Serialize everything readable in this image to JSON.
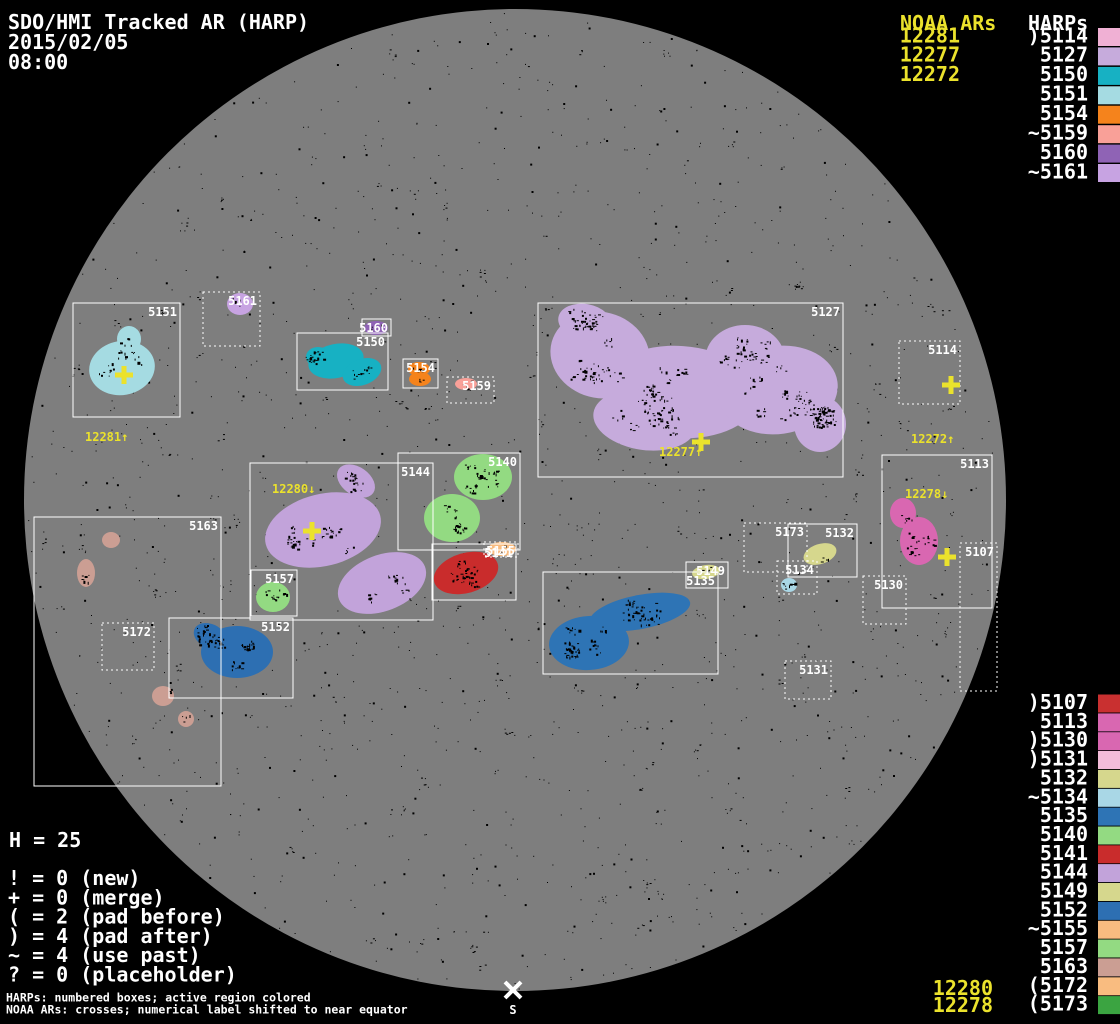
{
  "app": {
    "title": "SDO/HMI Tracked AR (HARP)",
    "date": "2015/02/05",
    "time": "08:00"
  },
  "colors": {
    "background": "#000000",
    "disk_gray": "#7e7e7e",
    "accent_yellow": "#ebe22c",
    "label_white": "#ffffff",
    "box_stroke": "#ffffff",
    "speckle_black": "#000000"
  },
  "columns": {
    "noaa_header": "NOAA ARs",
    "harps_header": "HARPs"
  },
  "noaa_top_list": [
    "12281",
    "12277",
    "12272"
  ],
  "noaa_bottom_list": [
    {
      "text": "12280",
      "baseline": 995
    },
    {
      "text": "12278",
      "baseline": 1012
    }
  ],
  "harps_top_list": [
    {
      "label": ")5114",
      "color": "#f0b0d4"
    },
    {
      "label": "5127",
      "color": "#c6abdc"
    },
    {
      "label": "5150",
      "color": "#17b1c3"
    },
    {
      "label": "5151",
      "color": "#a5dbe2"
    },
    {
      "label": "5154",
      "color": "#f5831c"
    },
    {
      "label": "~5159",
      "color": "#f9a098"
    },
    {
      "label": "5160",
      "color": "#8f63b5"
    },
    {
      "label": "~5161",
      "color": "#c7a3e2"
    }
  ],
  "harps_bottom_list": [
    {
      "label": ")5107",
      "color": "#c93030"
    },
    {
      "label": "5113",
      "color": "#d967b1"
    },
    {
      "label": ")5130",
      "color": "#d967b1"
    },
    {
      "label": ")5131",
      "color": "#f3bcd9"
    },
    {
      "label": "5132",
      "color": "#d6d78d"
    },
    {
      "label": "~5134",
      "color": "#a9d7e6"
    },
    {
      "label": "5135",
      "color": "#2e74b5"
    },
    {
      "label": "5140",
      "color": "#93da82"
    },
    {
      "label": "5141",
      "color": "#c92c2c"
    },
    {
      "label": "5144",
      "color": "#c2a3da"
    },
    {
      "label": "5149",
      "color": "#d6d78d"
    },
    {
      "label": "5152",
      "color": "#2d6fb2"
    },
    {
      "label": "~5155",
      "color": "#f9bc80"
    },
    {
      "label": "5157",
      "color": "#93da82"
    },
    {
      "label": "5163",
      "color": "#cb9e93"
    },
    {
      "label": "(5172",
      "color": "#f9bc80"
    },
    {
      "label": "(5173",
      "color": "#3ba441"
    }
  ],
  "legend": {
    "harp_count": "H = 25",
    "items": [
      "! = 0 (new)",
      "+ = 0 (merge)",
      "( = 2 (pad before)",
      ") = 4 (pad after)",
      "~ = 4 (use past)",
      "? = 0 (placeholder)"
    ]
  },
  "footnotes": [
    "HARPs: numbered boxes; active region colored",
    "NOAA ARs: crosses; numerical label shifted to near equator"
  ],
  "south_marker": {
    "label": "S",
    "x": 513,
    "y": 990
  },
  "chart_data": {
    "type": "scatter",
    "title": "SDO/HMI Tracked AR (HARP)",
    "datetime": "2015/02/05 08:00",
    "sun_disk": {
      "cx": 515,
      "cy": 500,
      "r": 491
    },
    "harp_regions": [
      {
        "harp": "5151",
        "box": [
          73,
          303,
          107,
          114
        ],
        "dashed": false,
        "color": "#a5dbe2",
        "parts": [
          [
            122,
            368,
            33,
            27,
            -10
          ],
          [
            129,
            339,
            12,
            13,
            0
          ],
          [
            126,
            352,
            9,
            11,
            0
          ]
        ],
        "spots": 42
      },
      {
        "harp": "5161",
        "box": [
          203,
          292,
          57,
          54
        ],
        "dashed": true,
        "color": "#c7a3e2",
        "parts": [
          [
            240,
            304,
            13,
            11,
            0
          ]
        ],
        "spots": 5
      },
      {
        "harp": "5160",
        "box": [
          362,
          319,
          29,
          17
        ],
        "dashed": false,
        "color": "#8f63b5",
        "parts": [
          [
            376,
            328,
            12,
            7,
            0
          ]
        ],
        "spots": 4
      },
      {
        "harp": "5150",
        "box": [
          297,
          333,
          91,
          57
        ],
        "dashed": false,
        "color": "#17b1c3",
        "parts": [
          [
            336,
            361,
            28,
            17,
            -12
          ],
          [
            362,
            372,
            20,
            13,
            -20
          ],
          [
            318,
            357,
            12,
            10,
            0
          ]
        ],
        "spots": 38
      },
      {
        "harp": "5154",
        "box": [
          403,
          359,
          35,
          29
        ],
        "dashed": false,
        "color": "#f5831c",
        "parts": [
          [
            419,
            369,
            11,
            7,
            0
          ],
          [
            420,
            379,
            11,
            7,
            0
          ]
        ],
        "spots": 12
      },
      {
        "harp": "5159",
        "box": [
          447,
          377,
          47,
          26
        ],
        "dashed": true,
        "color": "#f9a098",
        "parts": [
          [
            466,
            384,
            11,
            6,
            0
          ]
        ],
        "spots": 5
      },
      {
        "harp": "5127",
        "box": [
          538,
          303,
          305,
          174
        ],
        "dashed": false,
        "color": "#c6abdc",
        "parts": [
          [
            600,
            355,
            50,
            43,
            15
          ],
          [
            680,
            392,
            78,
            46,
            4
          ],
          [
            778,
            390,
            60,
            44,
            -8
          ],
          [
            645,
            420,
            52,
            30,
            8
          ],
          [
            820,
            424,
            26,
            28,
            0
          ],
          [
            585,
            322,
            27,
            18,
            10
          ],
          [
            745,
            360,
            40,
            35,
            0
          ]
        ],
        "spots": 430
      },
      {
        "harp": "5114",
        "box": [
          899,
          341,
          61,
          63
        ],
        "dashed": true,
        "color": null,
        "parts": [],
        "spots": 0
      },
      {
        "harp": "5113",
        "box": [
          882,
          455,
          110,
          153
        ],
        "dashed": false,
        "color": "#d967b1",
        "parts": [
          [
            919,
            541,
            19,
            24,
            0
          ],
          [
            903,
            513,
            13,
            15,
            0
          ]
        ],
        "spots": 26
      },
      {
        "harp": "5107",
        "box": [
          960,
          543,
          37,
          148
        ],
        "dashed": true,
        "color": null,
        "parts": [],
        "spots": 0
      },
      {
        "harp": "5130",
        "box": [
          863,
          576,
          43,
          48
        ],
        "dashed": true,
        "color": null,
        "parts": [],
        "spots": 3
      },
      {
        "harp": "5131",
        "box": [
          785,
          661,
          46,
          38
        ],
        "dashed": true,
        "color": null,
        "parts": [],
        "spots": 0
      },
      {
        "harp": "5173",
        "box": [
          744,
          523,
          63,
          49
        ],
        "dashed": true,
        "color": null,
        "parts": [],
        "spots": 0
      },
      {
        "harp": "5132",
        "box": [
          788,
          524,
          69,
          53
        ],
        "dashed": false,
        "color": "#d6d78d",
        "parts": [
          [
            820,
            554,
            17,
            10,
            -18
          ]
        ],
        "spots": 9
      },
      {
        "harp": "5134",
        "box": [
          777,
          561,
          40,
          33
        ],
        "dashed": true,
        "color": "#a9d7e6",
        "parts": [
          [
            789,
            585,
            8,
            7,
            0
          ]
        ],
        "spots": 4
      },
      {
        "harp": "5135",
        "box": [
          543,
          572,
          175,
          102
        ],
        "dashed": false,
        "color": "#2e74b5",
        "parts": [
          [
            640,
            612,
            51,
            17,
            -11
          ],
          [
            589,
            643,
            40,
            27,
            -4
          ]
        ],
        "spots": 130
      },
      {
        "harp": "5149",
        "box": [
          686,
          562,
          42,
          26
        ],
        "dashed": false,
        "color": "#d6d78d",
        "parts": [
          [
            706,
            572,
            14,
            7,
            -8
          ]
        ],
        "spots": 7
      },
      {
        "harp": "5144",
        "box": [
          250,
          463,
          183,
          157
        ],
        "dashed": false,
        "color": "#c2a3da",
        "parts": [
          [
            323,
            530,
            59,
            36,
            -14
          ],
          [
            356,
            481,
            21,
            14,
            35
          ],
          [
            382,
            583,
            46,
            28,
            -21
          ]
        ],
        "spots": 120
      },
      {
        "harp": "5140",
        "box": [
          398,
          453,
          122,
          97
        ],
        "dashed": false,
        "color": "#93da82",
        "parts": [
          [
            483,
            477,
            29,
            23,
            0
          ],
          [
            452,
            518,
            28,
            24,
            0
          ]
        ],
        "spots": 70
      },
      {
        "harp": "5141",
        "box": [
          432,
          544,
          84,
          56
        ],
        "dashed": false,
        "color": "#c92c2c",
        "parts": [
          [
            466,
            573,
            33,
            20,
            -16
          ]
        ],
        "spots": 45
      },
      {
        "harp": "5155",
        "box": [
          484,
          542,
          34,
          15
        ],
        "dashed": true,
        "color": "#f9bc80",
        "parts": [
          [
            502,
            549,
            14,
            7,
            0
          ]
        ],
        "spots": 5
      },
      {
        "harp": "5157",
        "box": [
          251,
          570,
          46,
          46
        ],
        "dashed": false,
        "color": "#93da82",
        "parts": [
          [
            273,
            597,
            17,
            15,
            0
          ]
        ],
        "spots": 14
      },
      {
        "harp": "5152",
        "box": [
          169,
          618,
          124,
          80
        ],
        "dashed": false,
        "color": "#2d6fb2",
        "parts": [
          [
            237,
            652,
            36,
            26,
            0
          ],
          [
            210,
            636,
            17,
            12,
            25
          ]
        ],
        "spots": 60
      },
      {
        "harp": "5163",
        "box": [
          34,
          517,
          187,
          269
        ],
        "dashed": false,
        "color": "#cb9e93",
        "parts": [
          [
            111,
            540,
            9,
            8,
            0
          ],
          [
            86,
            573,
            9,
            14,
            0
          ],
          [
            163,
            696,
            11,
            10,
            0
          ],
          [
            186,
            719,
            8,
            8,
            0
          ]
        ],
        "spots": 18
      },
      {
        "harp": "5172",
        "box": [
          102,
          623,
          52,
          47
        ],
        "dashed": true,
        "color": null,
        "parts": [],
        "spots": 0
      }
    ],
    "noaa_crosses": [
      {
        "noaa": "12281",
        "x": 124,
        "y": 375
      },
      {
        "noaa": "12280",
        "x": 312,
        "y": 531
      },
      {
        "noaa": "12277",
        "x": 701,
        "y": 442
      },
      {
        "noaa": "12272",
        "x": 951,
        "y": 385
      },
      {
        "noaa": "12278",
        "x": 947,
        "y": 557
      }
    ],
    "noaa_disk_labels": [
      {
        "text": "12281↑",
        "x": 85,
        "y": 441
      },
      {
        "text": "12280↓",
        "x": 272,
        "y": 493
      },
      {
        "text": "12277↑",
        "x": 659,
        "y": 456
      },
      {
        "text": "12272↑",
        "x": 911,
        "y": 443
      },
      {
        "text": "12278↓",
        "x": 905,
        "y": 498
      }
    ]
  }
}
